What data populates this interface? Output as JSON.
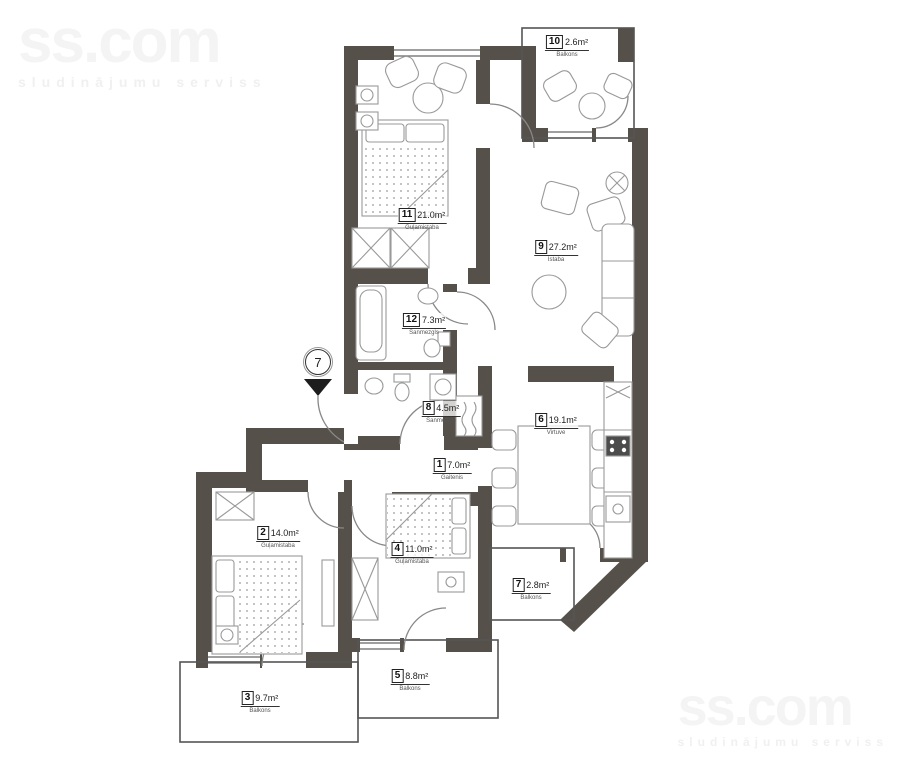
{
  "watermarks": {
    "brand": "ss.com",
    "tagline": "sludinājumu serviss"
  },
  "entrance": {
    "label": "7"
  },
  "rooms": [
    {
      "number": "1",
      "area": "7.0m²",
      "name": "Gaitenis"
    },
    {
      "number": "2",
      "area": "14.0m²",
      "name": "Guļamistaba"
    },
    {
      "number": "3",
      "area": "9.7m²",
      "name": "Balkons"
    },
    {
      "number": "4",
      "area": "11.0m²",
      "name": "Guļamistaba"
    },
    {
      "number": "5",
      "area": "8.8m²",
      "name": "Balkons"
    },
    {
      "number": "6",
      "area": "19.1m²",
      "name": "Virtuve"
    },
    {
      "number": "7",
      "area": "2.8m²",
      "name": "Balkons"
    },
    {
      "number": "8",
      "area": "4.5m²",
      "name": "Sanmezgls"
    },
    {
      "number": "9",
      "area": "27.2m²",
      "name": "Istaba"
    },
    {
      "number": "10",
      "area": "2.6m²",
      "name": "Balkons"
    },
    {
      "number": "11",
      "area": "21.0m²",
      "name": "Guļamistaba"
    },
    {
      "number": "12",
      "area": "7.3m²",
      "name": "Sanmezgls"
    }
  ],
  "colors": {
    "wall": "#56504a",
    "furniture_stroke": "#999999",
    "thin_wall": "#555555",
    "watermark": "#f2f2f2"
  }
}
